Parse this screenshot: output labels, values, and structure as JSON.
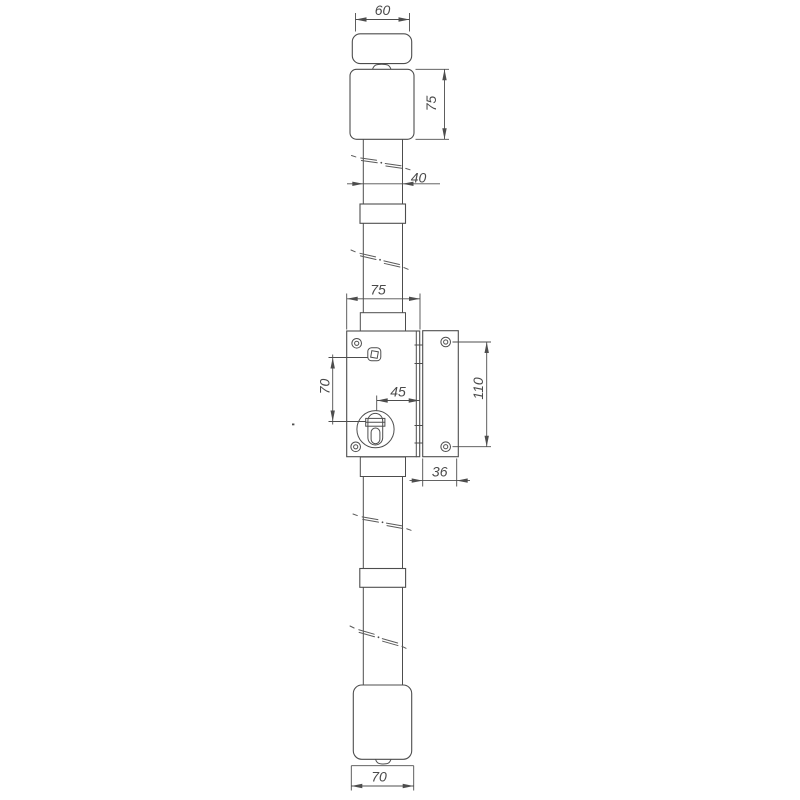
{
  "drawing": {
    "name": "vertical-rod-lock-technical-drawing",
    "colors": {
      "background": "#ffffff",
      "line": "#4d4d4d",
      "text": "#4a4a4a"
    },
    "labels": {
      "top_knob_width": "60",
      "top_housing_height": "75",
      "rod_diameter": "40",
      "case_width": "75",
      "spindle_to_cylinder": "70",
      "cylinder_to_edge": "45",
      "faceplate_hole_spacing": "110",
      "faceplate_width": "36",
      "bottom_cap_width": "70"
    }
  }
}
